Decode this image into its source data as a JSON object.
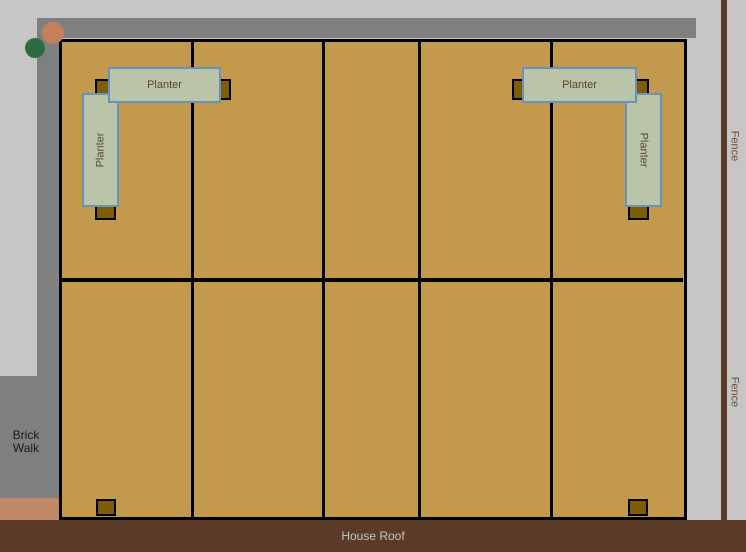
{
  "labels": {
    "house_roof": "House Roof",
    "brick_walk": "Brick Walk"
  },
  "fence": {
    "labels": [
      "Fence",
      "Fence"
    ]
  },
  "planters": {
    "top_left": {
      "label": "Planter"
    },
    "left": {
      "label": "Planter"
    },
    "top_right": {
      "label": "Planter"
    },
    "right": {
      "label": "Planter"
    }
  },
  "colors": {
    "background": "#c6c6c6",
    "walkway-gray": "#7f7f7f",
    "walk-end-salmon": "#c28764",
    "brick-walk-text": "#1a1a1a",
    "deck-tan": "#c3994e",
    "grid-line": "#000000",
    "post-fill": "#7e5d06",
    "planter-fill": "#b9c4a9",
    "planter-border": "#6593be",
    "planter-text": "#5a4632",
    "fence-brown": "#5b3a28",
    "fence-text": "#7a4a28",
    "roof-brown": "#5b3a28",
    "roof-text": "#c6c6c6",
    "tree-orange": "#c57f5b",
    "tree-green": "#2e6b44"
  }
}
